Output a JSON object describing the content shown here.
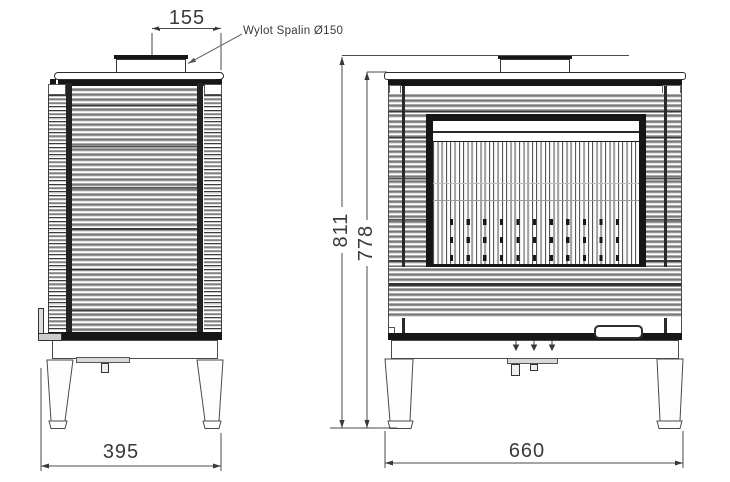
{
  "annotations": {
    "flue_outlet_label": "Wylot Spalin Ø150",
    "dim_flue_to_back": "155",
    "dim_overall_height": "811",
    "dim_body_height": "778",
    "dim_depth": "395",
    "dim_width": "660"
  },
  "colors": {
    "line": "#3f3f3f",
    "dark_fill": "#161616",
    "rib_gray": "#9a9a9a"
  }
}
